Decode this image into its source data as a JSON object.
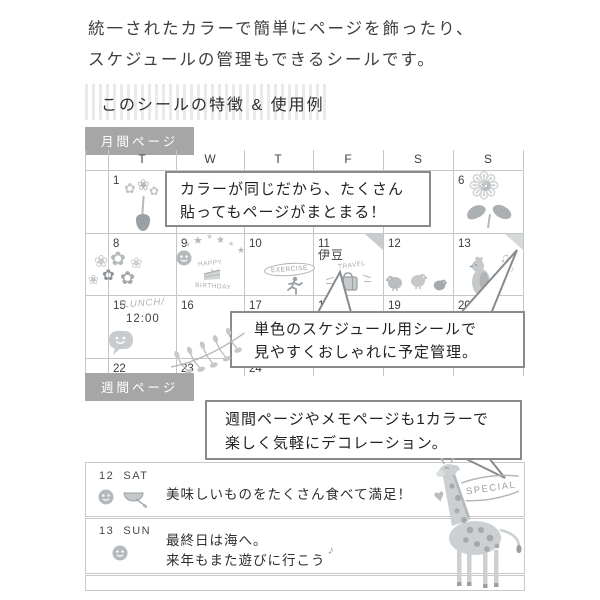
{
  "intro": {
    "line1": "統一されたカラーで簡単にページを飾ったり、",
    "line2": "スケジュールの管理もできるシールです。"
  },
  "section_header": "このシールの特徴 & 使用例",
  "monthly": {
    "label": "月間ページ",
    "weekday_headers": [
      "T",
      "W",
      "T",
      "F",
      "S",
      "S"
    ],
    "day_numbers": [
      [
        "1",
        "",
        "",
        "",
        "",
        "6"
      ],
      [
        "8",
        "9",
        "10",
        "11",
        "12",
        "13"
      ],
      [
        "15",
        "16",
        "17",
        "18",
        "19",
        "20"
      ],
      [
        "22",
        "23",
        "24",
        "",
        "",
        ""
      ]
    ],
    "day11_note": "伊豆",
    "bubble1": {
      "line1": "カラーが同じだから、たくさん",
      "line2": "貼ってもページがまとまる！"
    },
    "bubble2": {
      "line1": "単色のスケジュール用シールで",
      "line2": "見やすくおしゃれに予定管理。"
    },
    "stickers": {
      "birthday_top": "HAPPY",
      "birthday_bottom": "BIRTHDAY",
      "exercise": "EXERCISE",
      "travel": "TRAVEL",
      "lunch": "\\LUNCH/",
      "lunch_time": "12:00"
    }
  },
  "weekly": {
    "label": "週間ページ",
    "bubble3": {
      "line1": "週間ページやメモページも1カラーで",
      "line2": "楽しく気軽にデコレーション。"
    },
    "rows": [
      {
        "date": "12",
        "day": "SAT",
        "text1": "美味しいものをたくさん食べて満足！",
        "text2": ""
      },
      {
        "date": "13",
        "day": "SUN",
        "text1": "最終日は海へ。",
        "text2": "来年もまた遊びに行こう"
      }
    ],
    "special_badge": "SPECIAL"
  },
  "icons": {
    "star": "★",
    "flower": "✿",
    "flower_outline": "❀",
    "sunflower": "❁",
    "heart_filled": "♥",
    "heart_outline": "♡",
    "music_note": "♪",
    "music_notes": "♫"
  },
  "colors": {
    "label_bg": "#a6a6a6",
    "grid_line": "#c6c6c6",
    "bubble_border": "#8a8a8a",
    "sticker_gray": "#c3c6c8",
    "text_dark": "#3d3d3d"
  }
}
